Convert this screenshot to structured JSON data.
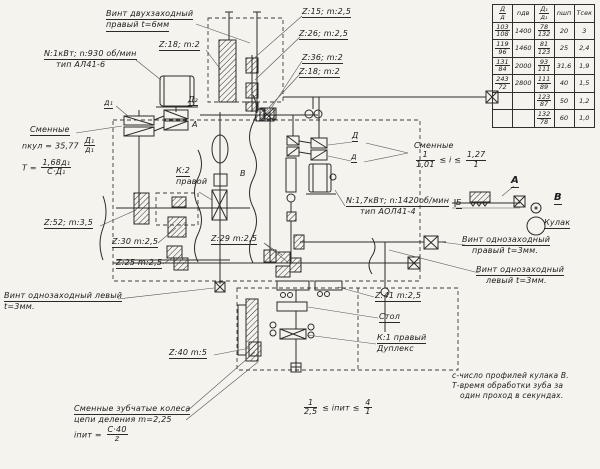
{
  "colors": {
    "paper": "#f4f3ee",
    "ink": "#1c1c1c"
  },
  "table": {
    "headers": [
      {
        "num": "Д",
        "den": "д"
      },
      "nдв",
      {
        "num": "Д₁",
        "den": "д₁"
      },
      "nшп",
      "Тсек"
    ],
    "rows": [
      [
        {
          "num": "103",
          "den": "108"
        },
        "1400",
        {
          "num": "78",
          "den": "132"
        },
        "20",
        "3"
      ],
      [
        {
          "num": "119",
          "den": "96"
        },
        "1460",
        {
          "num": "81",
          "den": "123"
        },
        "25",
        "2,4"
      ],
      [
        {
          "num": "131",
          "den": "84"
        },
        "2000",
        {
          "num": "93",
          "den": "111"
        },
        "31,6",
        "1,9"
      ],
      [
        {
          "num": "243",
          "den": "72"
        },
        "2800",
        {
          "num": "111",
          "den": "89"
        },
        "40",
        "1,5"
      ],
      [
        "",
        "",
        {
          "num": "123",
          "den": "87"
        },
        "50",
        "1,2"
      ],
      [
        "",
        "",
        {
          "num": "132",
          "den": "78"
        },
        "60",
        "1,0"
      ]
    ]
  },
  "labels": {
    "vint2_1": "Винт двухзаходный",
    "vint2_2": "правый t=6мм",
    "z18a": "Z:18; m:2",
    "motor1_1": "N:1кВт; n:930 об/мин",
    "motor1_2": "тип АЛ41-6",
    "z15": "Z:15; m:2,5",
    "z26": "Z:26; m:2,5",
    "z36": "Z:36; m:2",
    "z18b": "Z:18; m:2",
    "smen1": "Сменные",
    "nkul_pre": "nкул = 35,77",
    "nkul_num": "Д₁",
    "nkul_den": "д₁",
    "t_pre": "T =",
    "t_num": "1,68д₁",
    "t_den": "С·Д₁",
    "z52": "Z:52; m:3,5",
    "z30": "Z:30 m:2,5",
    "z25": "Z:25 m:2,5",
    "k2_1": "К:2",
    "k2_2": "правой",
    "z29": "Z:29 m:2,5",
    "vintL1_1": "Винт однозаходный левый",
    "vintL1_2": "t=3мм.",
    "z40": "Z:40 m:5",
    "smen2_1": "Сменные зубчатые колеса",
    "smen2_2": "цепи деления m=2,25",
    "ipit_pre": "iпит =",
    "ipit_num": "С·40",
    "ipit_den": "z",
    "r2_n1": "1",
    "r2_d1": "2,5",
    "r2_mid": "≤ iпит ≤",
    "r2_n2": "4",
    "r2_d2": "1",
    "pul_D": "Д",
    "pul_d": "д",
    "smen3": "Сменные",
    "s3_n1": "1",
    "s3_d1": "1,01",
    "s3_mid": "≤ i ≤",
    "s3_n2": "1,27",
    "s3_d2": "1",
    "motor2_1": "N:1,7кВт; n:1420об/мин",
    "motor2_2": "тип АОЛ41-4",
    "secA": "А",
    "secB": "В",
    "b_small": "Б",
    "kulak": "Кулак",
    "vintR_1": "Винт однозаходный",
    "vintR_2": "правый t=3мм.",
    "vintL2_1": "Винт однозаходный",
    "vintL2_2": "левый t=3мм.",
    "z41": "Z:41 m:2,5",
    "stol": "Стол",
    "k1_1": "К:1 правый",
    "k1_2": "Дуплекс",
    "note_1": "с-число профилей кулака В.",
    "note_2": "Т-время обработки зуба за",
    "note_3": "один проход в секундах.",
    "d1": "д₁",
    "D2": "Д₂",
    "A1": "А",
    "B1": "В"
  }
}
